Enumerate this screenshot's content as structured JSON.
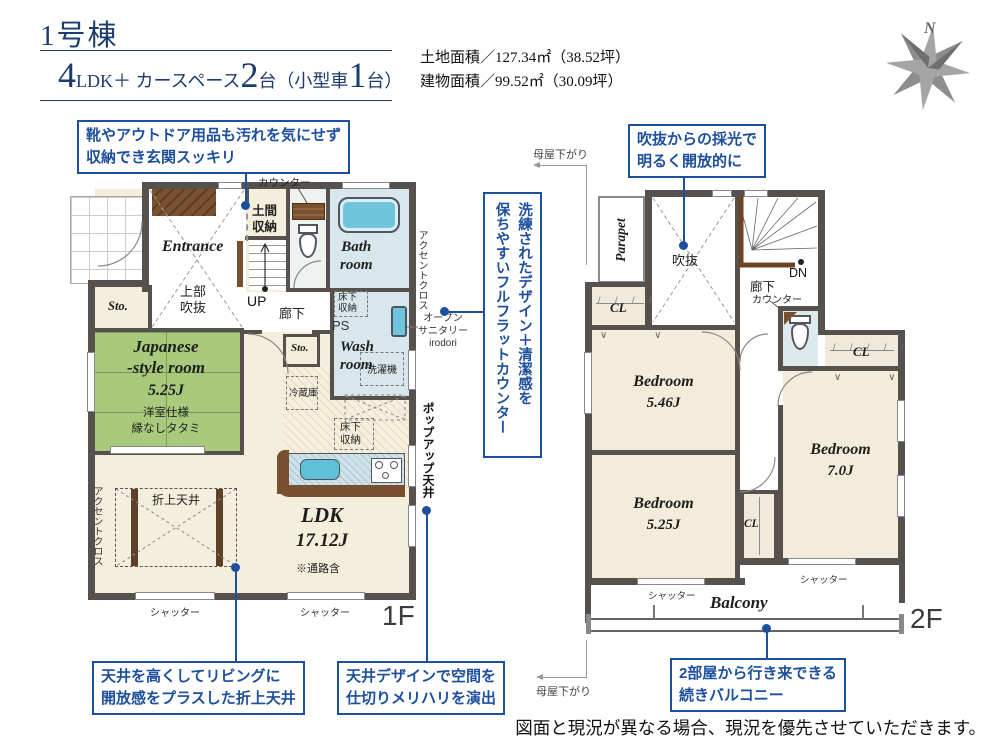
{
  "header": {
    "title": "1号棟",
    "big1": "4",
    "mid1": "LDK＋ カースペース",
    "big2": "2",
    "mid2": "台（小型車",
    "big3": "1",
    "mid3": "台）"
  },
  "site": {
    "land": "土地面積／127.34㎡（38.52坪）",
    "building": "建物面積／99.52㎡（30.09坪）"
  },
  "compass": {
    "n": "N"
  },
  "callouts": {
    "genkan": [
      "靴やアウトドア用品も汚れを気にせず",
      "収納でき玄関スッキリ"
    ],
    "void": [
      "吹抜からの採光で",
      "明るく開放的に"
    ],
    "counter": [
      "洗練されたデザイン＋清潔感を",
      "保ちやすいフルフラットカウンター"
    ],
    "oriage": [
      "天井を高くしてリビングに",
      "開放感をプラスした折上天井"
    ],
    "ceiling": [
      "天井デザインで空間を",
      "仕切りメリハリを演出"
    ],
    "balcony": [
      "2部屋から行き来できる",
      "続きバルコニー"
    ]
  },
  "notes": {
    "moya": "母屋下がり",
    "accent": "アクセントクロス",
    "popup": "ポップアップ天井",
    "sanitary": [
      "オープン",
      "サニタリー",
      "irodori"
    ],
    "shutter": "シャッター"
  },
  "f1": {
    "label": "1F",
    "entrance": "Entrance",
    "counter": "カウンター",
    "doma": [
      "土間",
      "収納"
    ],
    "joubu": [
      "上部",
      "吹抜"
    ],
    "up": "UP",
    "rouka": "廊下",
    "sto": "Sto.",
    "bath": [
      "Bath",
      "room"
    ],
    "yukashita": [
      "床下",
      "収納"
    ],
    "ps": "PS",
    "wash": [
      "Wash",
      "room"
    ],
    "washer": "洗濯機",
    "fridge": "冷蔵庫",
    "jroom": [
      "Japanese",
      "-style room",
      "5.25J",
      "洋室仕様",
      "縁なしタタミ"
    ],
    "oriage": "折上天井",
    "ldk": [
      "LDK",
      "17.12J",
      "※通路含"
    ]
  },
  "f2": {
    "label": "2F",
    "parapet": "Parapet",
    "void": "吹抜",
    "dn": "DN",
    "rouka": "廊下",
    "counter": "カウンター",
    "cl": "CL",
    "bed1": [
      "Bedroom",
      "5.46J"
    ],
    "bed2": [
      "Bedroom",
      "5.25J"
    ],
    "bed3": [
      "Bedroom",
      "7.0J"
    ],
    "balcony": "Balcony"
  },
  "footer": {
    "disclaimer": "図面と現況が異なる場合、現況を優先させていただきます。"
  },
  "colors": {
    "navy": "#1d3c6e",
    "callout_blue": "#1d4f9e",
    "wall": "#56514c",
    "tatami": "#a9ca7c",
    "water": "#d8e7ec",
    "tub": "#6fc5dc",
    "floor": "#f4eedd",
    "wood": "#77512f",
    "compass": "#8a8a8a"
  }
}
